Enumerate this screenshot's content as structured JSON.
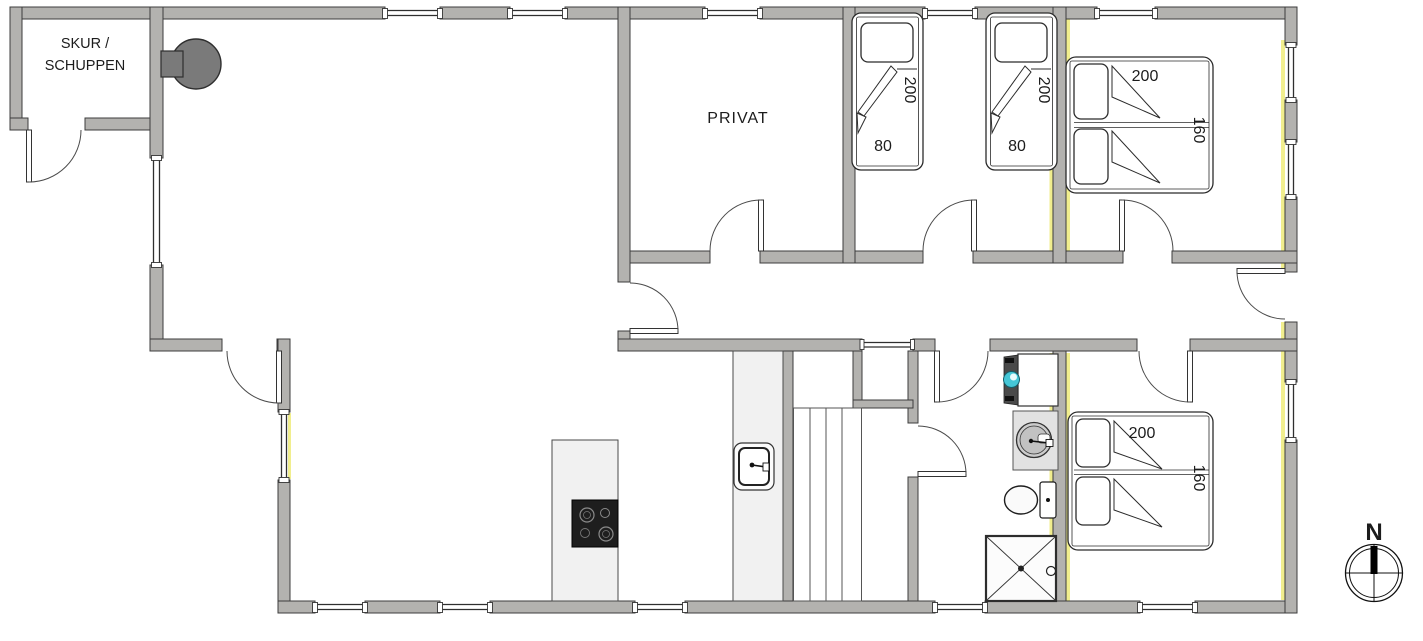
{
  "floor_plan": {
    "rooms": {
      "shed": {
        "label_line1": "SKUR /",
        "label_line2": "SCHUPPEN"
      },
      "private_room": {
        "label": "PRIVAT"
      }
    },
    "beds": {
      "single_bed_1": {
        "length_cm": "200",
        "width_cm": "80"
      },
      "single_bed_2": {
        "length_cm": "200",
        "width_cm": "80"
      },
      "double_bed_north": {
        "length_cm": "200",
        "width_cm": "160"
      },
      "double_bed_south": {
        "length_cm": "200",
        "width_cm": "160"
      }
    },
    "compass": {
      "north_label": "N"
    },
    "colors": {
      "wall_fill": "#b3b2af",
      "wall_outline": "#3c3c3c",
      "accent_yellow": "#f1ee8e",
      "fixture_fill": "#f1f1f1",
      "cooktop_black": "#1e1e1e",
      "washer_door_teal": "#45c6d6",
      "stove_gray": "#7a7a7a",
      "line": "#333333"
    }
  }
}
